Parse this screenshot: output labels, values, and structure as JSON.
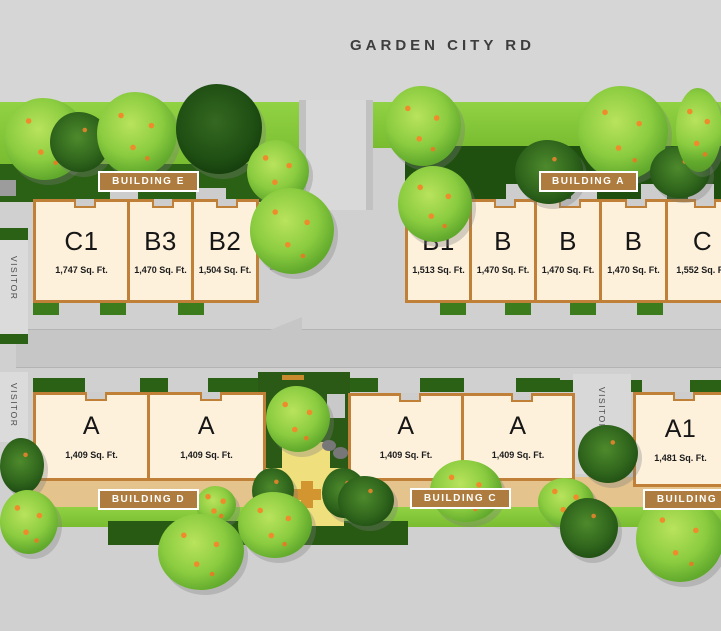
{
  "road": {
    "name": "GARDEN CITY RD"
  },
  "visitor_labels": [
    "VISITOR",
    "VISITOR",
    "VISITOR"
  ],
  "buildings": [
    {
      "label": "BUILDING E",
      "units": [
        {
          "name": "C1",
          "area": "1,747 Sq. Ft."
        },
        {
          "name": "B3",
          "area": "1,470 Sq. Ft."
        },
        {
          "name": "B2",
          "area": "1,504 Sq. Ft."
        }
      ]
    },
    {
      "label": "BUILDING A",
      "units": [
        {
          "name": "B1",
          "area": "1,513 Sq. Ft."
        },
        {
          "name": "B",
          "area": "1,470 Sq. Ft."
        },
        {
          "name": "B",
          "area": "1,470 Sq. Ft."
        },
        {
          "name": "B",
          "area": "1,470 Sq. Ft."
        },
        {
          "name": "C",
          "area": "1,552 Sq. Ft."
        }
      ]
    },
    {
      "label": "BUILDING D",
      "units": [
        {
          "name": "A",
          "area": "1,409 Sq. Ft."
        },
        {
          "name": "A",
          "area": "1,409 Sq. Ft."
        }
      ]
    },
    {
      "label": "BUILDING C",
      "units": [
        {
          "name": "A",
          "area": "1,409 Sq. Ft."
        },
        {
          "name": "A",
          "area": "1,409 Sq. Ft."
        }
      ]
    },
    {
      "label": "BUILDING B",
      "units": [
        {
          "name": "A1",
          "area": "1,481 Sq. Ft."
        }
      ]
    }
  ],
  "colors": {
    "unit_fill": "#fdf1dc",
    "unit_border": "#c08038",
    "building_label_bg": "#ad7c3e",
    "road_gray": "#d0d0d0",
    "grass_green": "#7fc437",
    "hedge_green": "#2b6114",
    "courtyard_sand": "#efdf7d"
  }
}
